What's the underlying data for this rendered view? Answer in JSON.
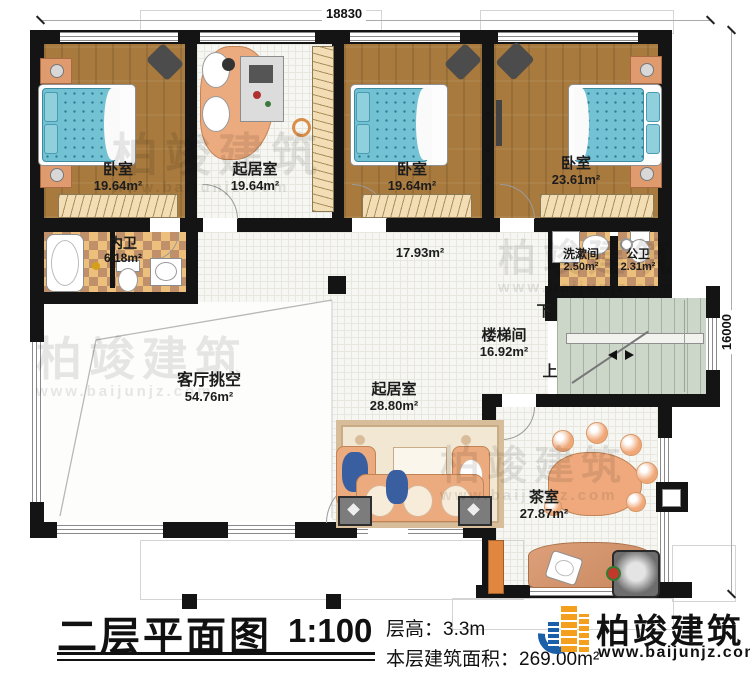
{
  "plan": {
    "title": "二层平面图",
    "scale": "1:100",
    "floor_height": "层高：3.3m",
    "floor_area": "本层建筑面积：269.00m²",
    "dim_top": "18830",
    "dim_right": "16000",
    "stair_down": "下",
    "stair_up": "上"
  },
  "rooms": [
    {
      "id": "bedroom-1",
      "name": "卧室",
      "area": "19.64m²"
    },
    {
      "id": "sitting-top",
      "name": "起居室",
      "area": "19.64m²"
    },
    {
      "id": "bedroom-2",
      "name": "卧室",
      "area": "19.64m²"
    },
    {
      "id": "bedroom-3",
      "name": "卧室",
      "area": "23.61m²"
    },
    {
      "id": "inner-bath",
      "name": "内卫",
      "area": "6.18m²"
    },
    {
      "id": "hallway",
      "name": "",
      "area": "17.93m²"
    },
    {
      "id": "washroom",
      "name": "洗漱间",
      "area": "2.50m²"
    },
    {
      "id": "public-toilet",
      "name": "公卫",
      "area": "2.31m²"
    },
    {
      "id": "stairwell",
      "name": "楼梯间",
      "area": "16.92m²"
    },
    {
      "id": "living-void",
      "name": "客厅挑空",
      "area": "54.76m²"
    },
    {
      "id": "sitting-lower",
      "name": "起居室",
      "area": "28.80m²"
    },
    {
      "id": "tea-room",
      "name": "茶室",
      "area": "27.87m²"
    }
  ],
  "watermark": {
    "text": "柏竣建筑",
    "url": "www.baijunjz.com"
  },
  "logo": {
    "name": "柏竣建筑",
    "url": "www.baijunjz.com"
  }
}
